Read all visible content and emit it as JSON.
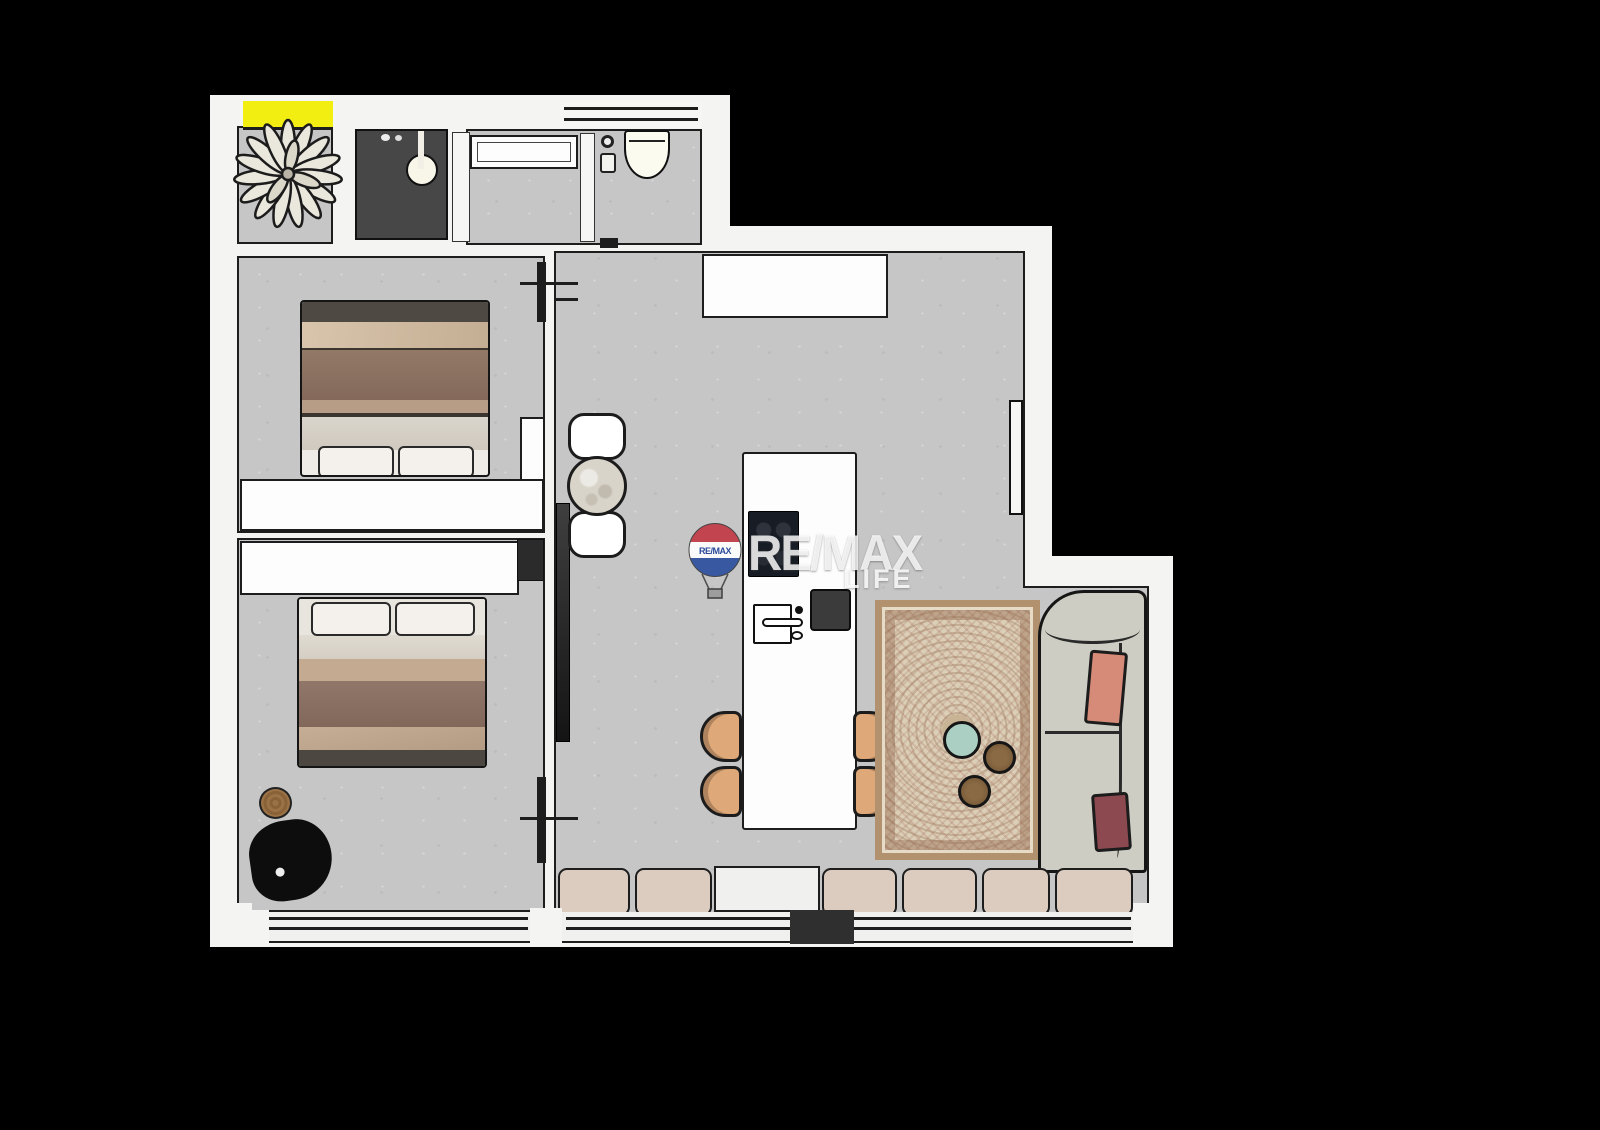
{
  "image_type": "apartment floor plan rendering",
  "watermark": {
    "balloon_text": "RE/MAX",
    "title": "RE/MAX",
    "subtitle": "LIFE"
  },
  "colors": {
    "bg": "#000000",
    "wall": "#f4f4f2",
    "floor": "#c6c6c6",
    "ink": "#1d1d1d",
    "accent-yellow": "#f2ee12",
    "cushion": "#dcccc0",
    "stool-tan": "#dfa878",
    "sofa": "#cdcdc3",
    "pillow-salmon": "#d58b78",
    "pillow-maroon": "#8c4a50",
    "rug-field": "#dccfb8",
    "rug-border": "#b2916e",
    "table-mint": "#abcfc2",
    "table-wood": "#8a6a44",
    "bed-blanket": "#8a7160",
    "bed-sheet": "#cdb89e",
    "appliance-dark": "#474747",
    "cooktop": "#171c25",
    "balloon-red": "#c13a44",
    "balloon-blue": "#2c4f9e"
  }
}
